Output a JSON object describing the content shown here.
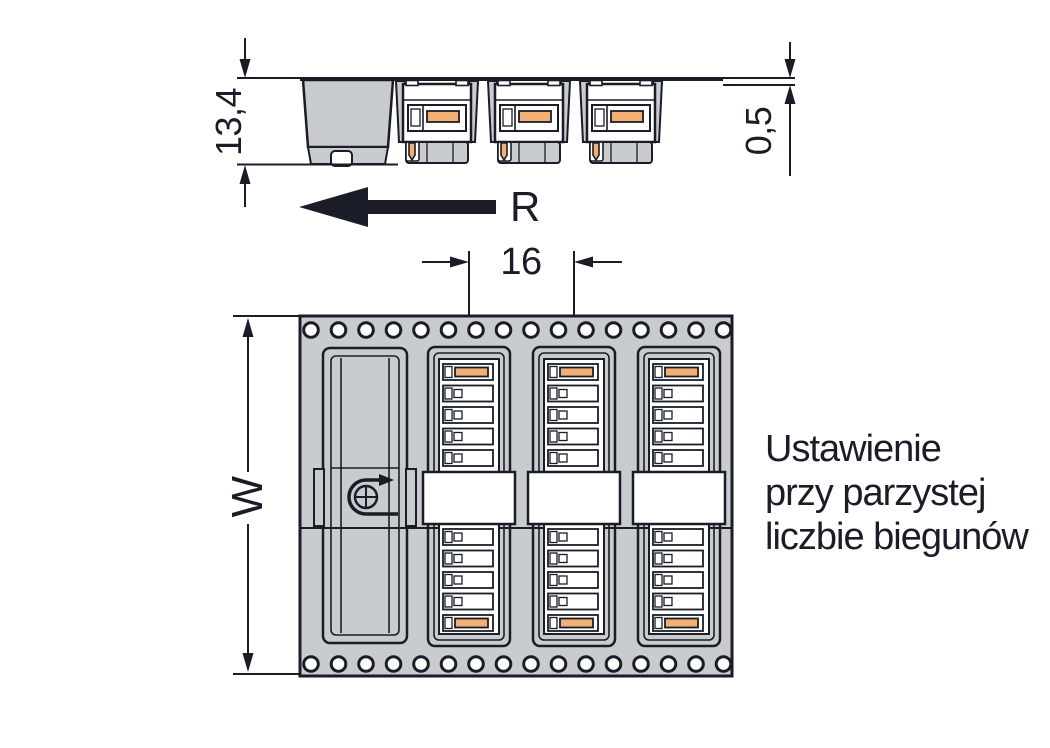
{
  "colors": {
    "line": "#1a1d27",
    "tape": "#c9cccf",
    "contact": "#f3b074",
    "background": "#ffffff"
  },
  "side_view": {
    "height_dim": "13,4",
    "film_dim": "0,5",
    "direction_label": "R"
  },
  "top_view": {
    "pitch_dim": "16",
    "width_dim": "W"
  },
  "note": {
    "line1": "Ustawienie",
    "line2": "przy parzystej",
    "line3": "liczbie biegunów"
  }
}
